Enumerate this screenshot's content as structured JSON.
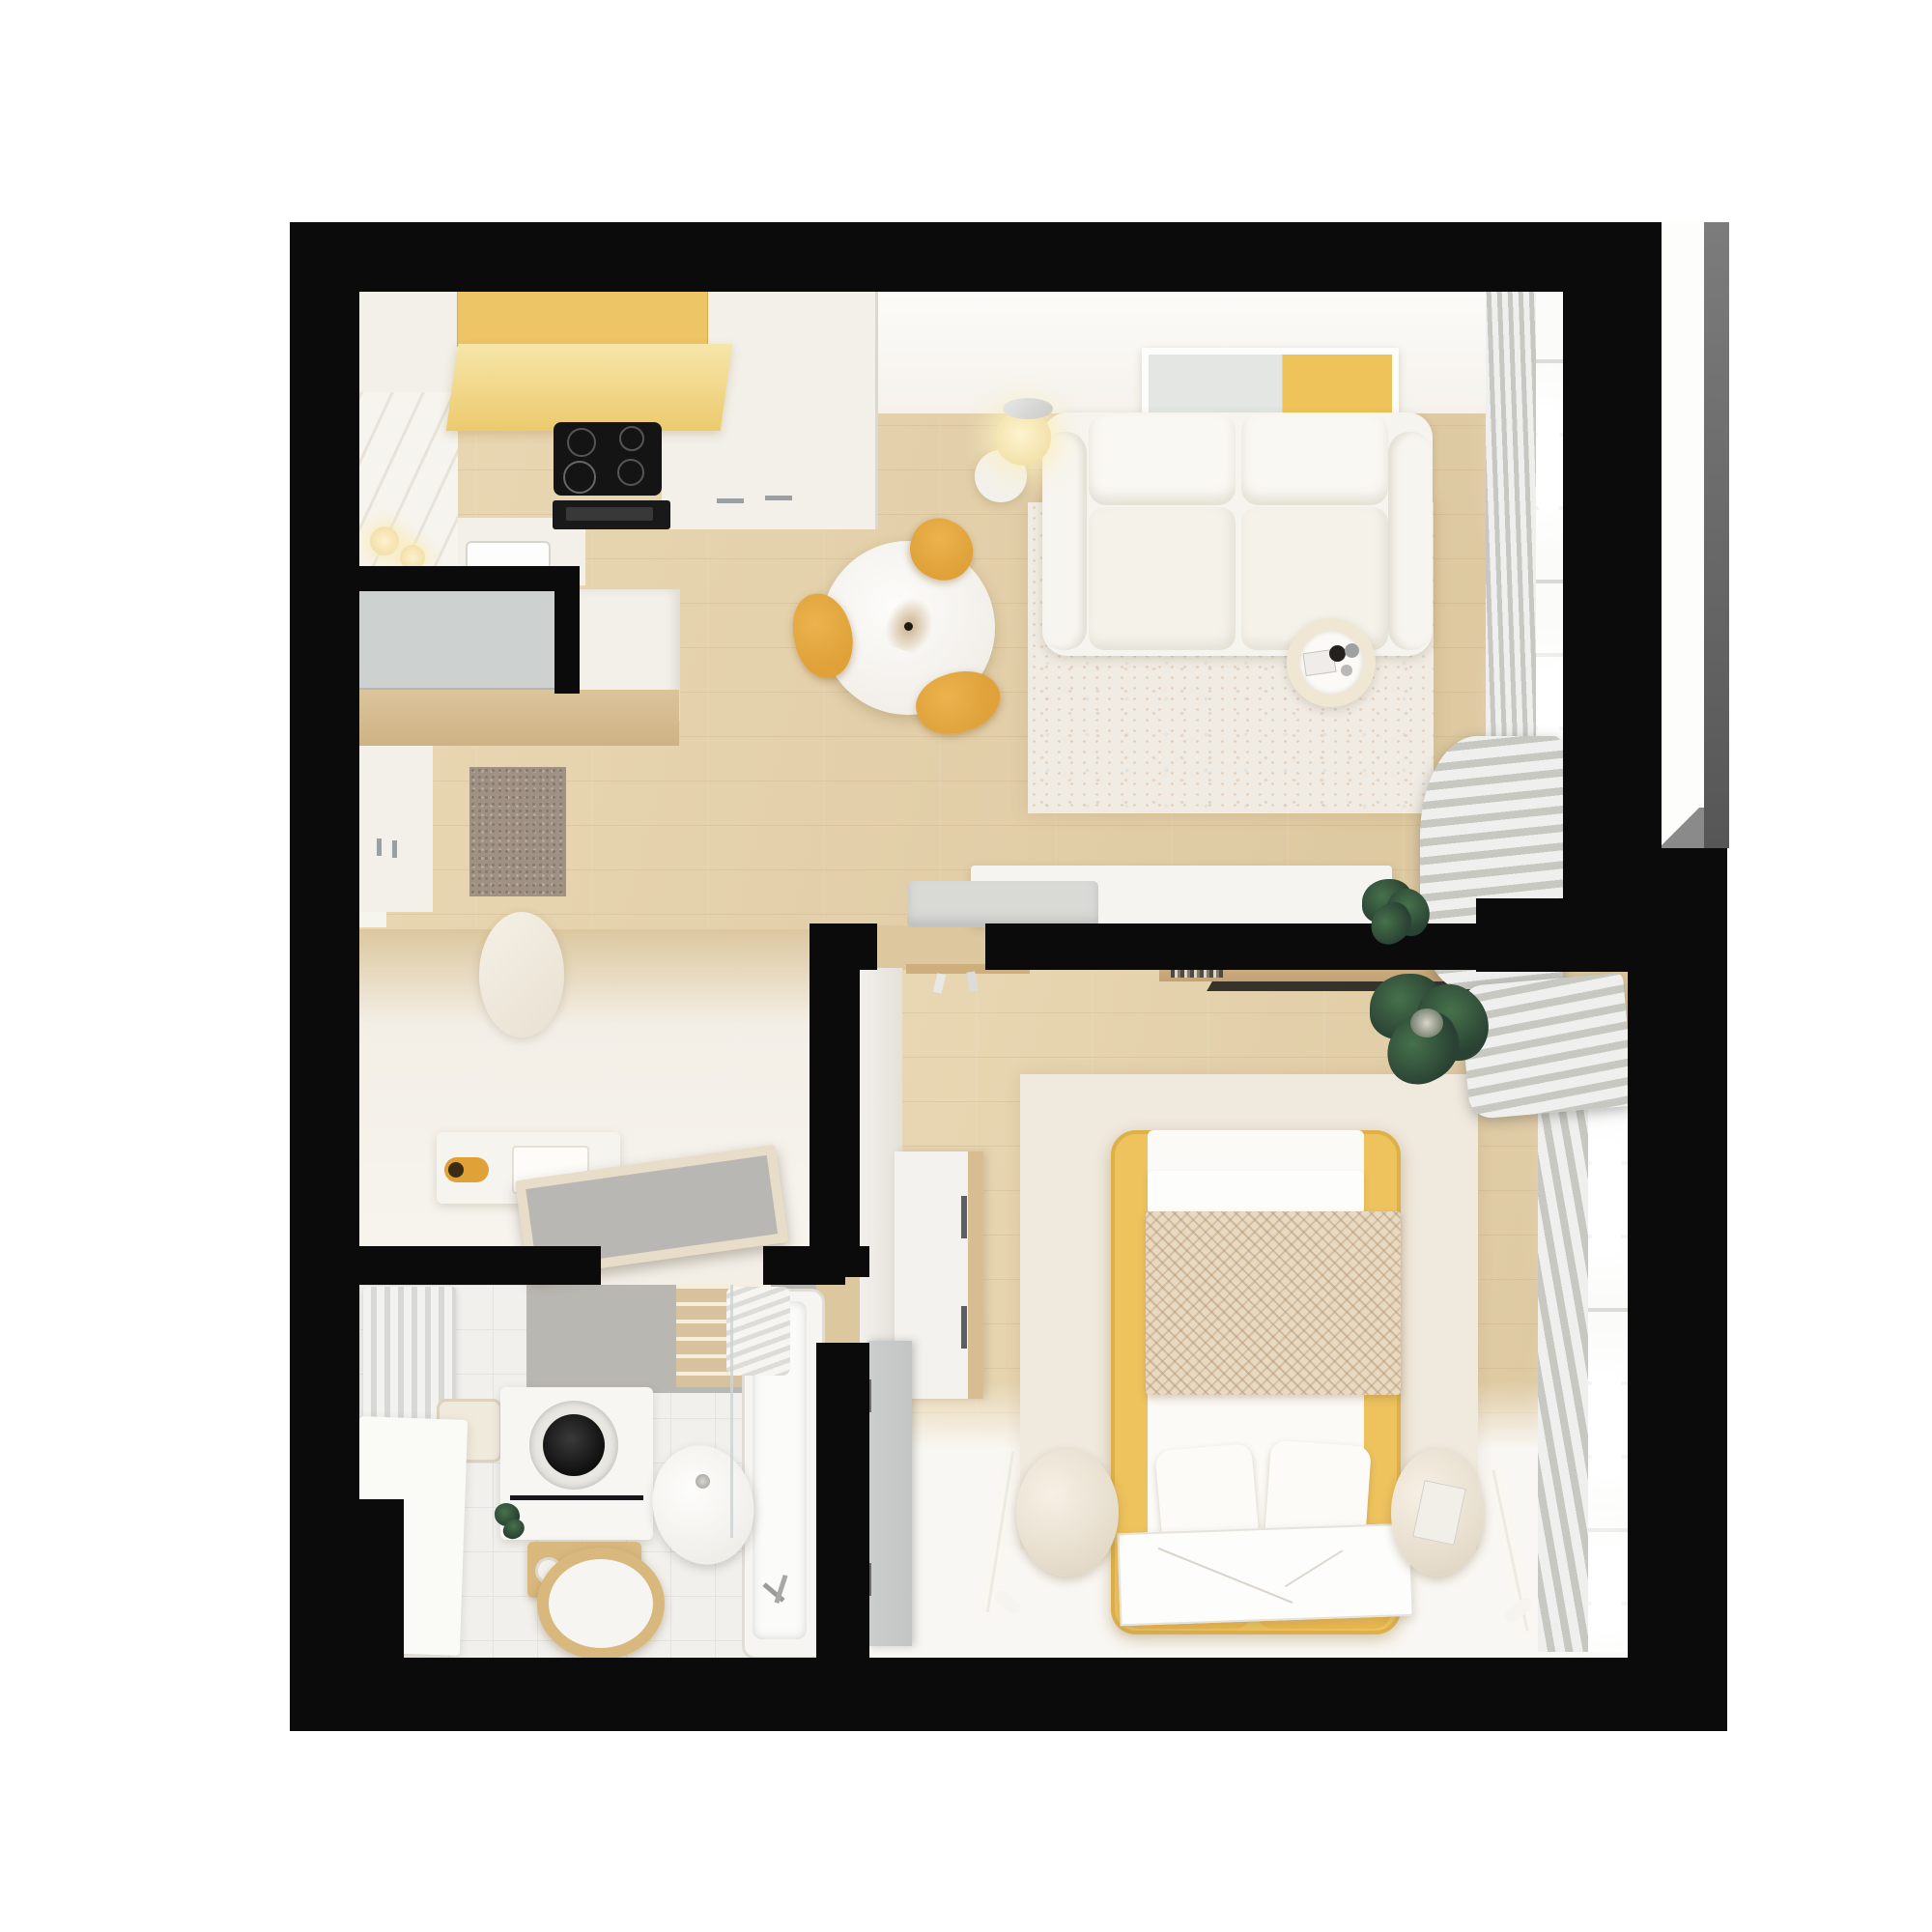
{
  "meta": {
    "title": "Top-down 3D render — one-bedroom apartment floor plan",
    "render_style": "photoreal top view, no text labels"
  },
  "colors": {
    "wall": "#0b0b0b",
    "woodFloor": "#e9d8b4",
    "woodFloorDeep": "#dcc79e",
    "creamFloor": "#f3efe7",
    "bathTile": "#f1f0ed",
    "cabinetWhite": "#f2f0e9",
    "cabinetYellow": "#eec566",
    "hoodYellow": "#f6e6aa",
    "hoodYellowDeep": "#ecca6d",
    "stoveBlack": "#141414",
    "wardrobeGray": "#cdd1d0",
    "woodShelf": "#d5bb8f",
    "doormat": "#a09184",
    "rugLiving": "#f0ebe3",
    "rugBedroom": "#efe9de",
    "sofaWhite": "#f6f4ef",
    "tableWhite": "#fbfaf7",
    "chairYellow": "#dfa138",
    "artYellow": "#eec45a",
    "artGray": "#e3e6e2",
    "bedYellow": "#eec25d",
    "cushionYellow": "#edb94f",
    "blanket": "#e8d9c3",
    "nightstandCream": "#eee6d6",
    "curtainLight": "#efefed",
    "curtainDark": "#c8c8c3",
    "windowWhite": "#fbfbfa",
    "loggiaGray": "#6f6f6f",
    "doorGray": "#c2c5c4",
    "glassGray": "#b9b7b4",
    "tileGrayWall": "#b9b7b2",
    "tileBeige": "#d8c29d",
    "plantDark": "#2a4234",
    "plantLight": "#46714b",
    "basketWood": "#d9b87e",
    "consoleWhite": "#f5f4f0",
    "benchGray": "#d9d9d6"
  },
  "scene": {
    "rooms": [
      {
        "name": "kitchen",
        "furniture": [
          "yellow-upper-cabinets",
          "extractor-hood",
          "induction-cooktop",
          "oven",
          "white-counter-run",
          "shiplap-backsplash",
          "wall-sconces",
          "sink",
          "tall-cabinet-column"
        ]
      },
      {
        "name": "living-room",
        "furniture": [
          "two-seat-sofa",
          "wall-art-yellow",
          "floor-lamp",
          "side-table",
          "coffee-table-with-tray",
          "distressed-rug",
          "dining-table-round",
          "dining-chairs-yellow-x3",
          "pampas-vase",
          "tv-console",
          "gray-bench",
          "floor-plant",
          "window-curtains"
        ]
      },
      {
        "name": "hallway",
        "furniture": [
          "gray-wardrobe",
          "white-wardrobe",
          "wood-shelf",
          "wall-cabinet",
          "doormat",
          "oval-pouf",
          "storage-bench-with-yellow-roll",
          "open-glass-door"
        ]
      },
      {
        "name": "bathroom",
        "furniture": [
          "towel-radiator",
          "towel-cube",
          "side-counter",
          "washing-machine",
          "bottle-shelf",
          "toilet",
          "wood-ring-basket",
          "bathtub",
          "shower-glass",
          "gray-wall-tiles",
          "beige-towel-ladder"
        ]
      },
      {
        "name": "bedroom",
        "furniture": [
          "yellow-frame-bed",
          "herringbone-blanket",
          "pillows",
          "headboard-cushions",
          "nightstand-left",
          "nightstand-right",
          "floor-lamp-left",
          "floor-lamp-right",
          "leaning-print",
          "sideboard-wood-top",
          "book-ledge",
          "hanger-rail",
          "corner-plant",
          "roman-shade-stack",
          "window-curtains",
          "open-door-white",
          "open-door-gray"
        ]
      },
      {
        "name": "loggia-niche",
        "furniture": []
      }
    ]
  }
}
